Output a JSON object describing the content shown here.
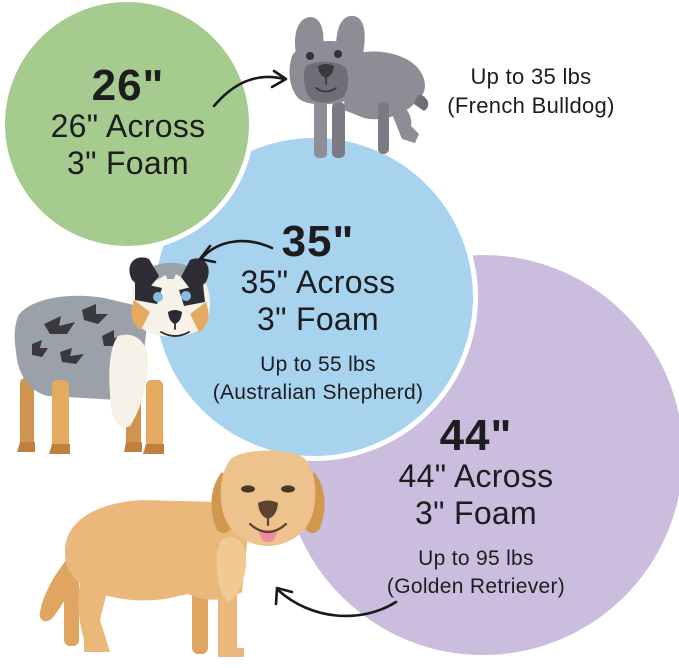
{
  "canvas": {
    "width": 679,
    "height": 668,
    "background": "#ffffff"
  },
  "colors": {
    "text": "#1d1d20",
    "arrow": "#1a1a1a"
  },
  "sizes": [
    {
      "badge": "26\"",
      "across": "26\" Across",
      "foam": "3\" Foam",
      "weight": "Up to 35 lbs",
      "breed": "(French Bulldog)",
      "circle_color": "#a6cb8f",
      "dog": "french-bulldog"
    },
    {
      "badge": "35\"",
      "across": "35\" Across",
      "foam": "3\" Foam",
      "weight": "Up to 55 lbs",
      "breed": "(Australian Shepherd)",
      "circle_color": "#a8d3ef",
      "dog": "australian-shepherd"
    },
    {
      "badge": "44\"",
      "across": "44\" Across",
      "foam": "3\" Foam",
      "weight": "Up to 95 lbs",
      "breed": "(Golden Retriever)",
      "circle_color": "#cbbddd",
      "dog": "golden-retriever"
    }
  ]
}
